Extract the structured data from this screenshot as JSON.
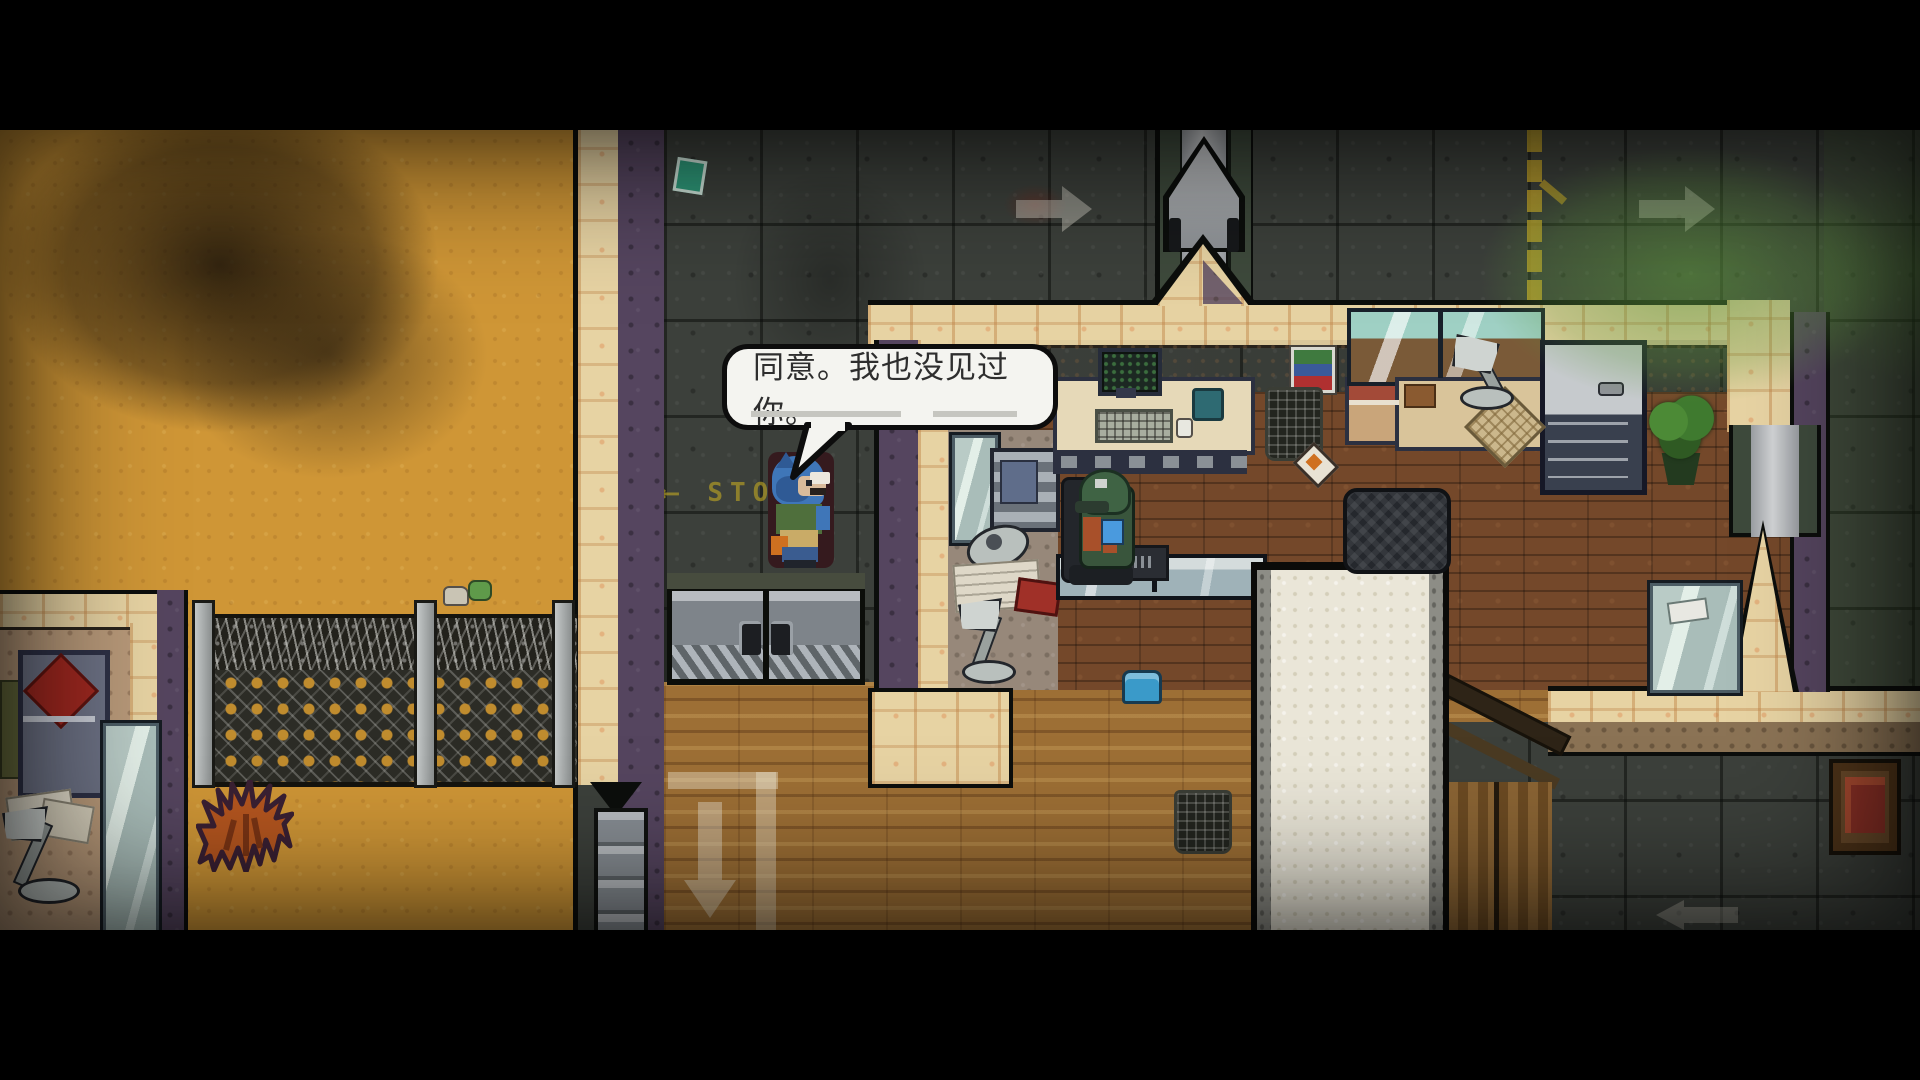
{
  "dialogue": {
    "text": "同意。我也没见过你。"
  },
  "floor_marking": {
    "arrow_glyph": "⟵",
    "text": "STOP"
  },
  "icons": {
    "arrow_right": "➜",
    "arrow_down": "⬇",
    "arrow_left": "⬅"
  },
  "colors": {
    "letterbox": "#000000",
    "sand": "#cf9636",
    "dark_tile": "#3c403b",
    "wall_tan": "#e7d3a3",
    "wall_purple": "#55455f",
    "interior_band": "#c3ad8a",
    "wood_room": "#74482a",
    "wood_hall": "#9d6f35",
    "cream_path": "#eae6d8",
    "door_gray": "#7e848a",
    "fence_dark": "#2c2c26",
    "fire_orange": "#b5561f",
    "gas_green": "#5a9440",
    "pipe_yellow": "#c9a82a",
    "arrow_white": "#eae5d8",
    "bubble_fill": "#f4f4f0",
    "bubble_border": "#0d0d0d",
    "dialogue_text": "#2e2e2e",
    "player_blue": "#3a72b5",
    "player_vest": "#4f6f3c",
    "guard_green": "#39553c",
    "glass_teal": "#b9cbc6",
    "bed_red": "#a02820",
    "plant_green": "#3f7a2f"
  }
}
